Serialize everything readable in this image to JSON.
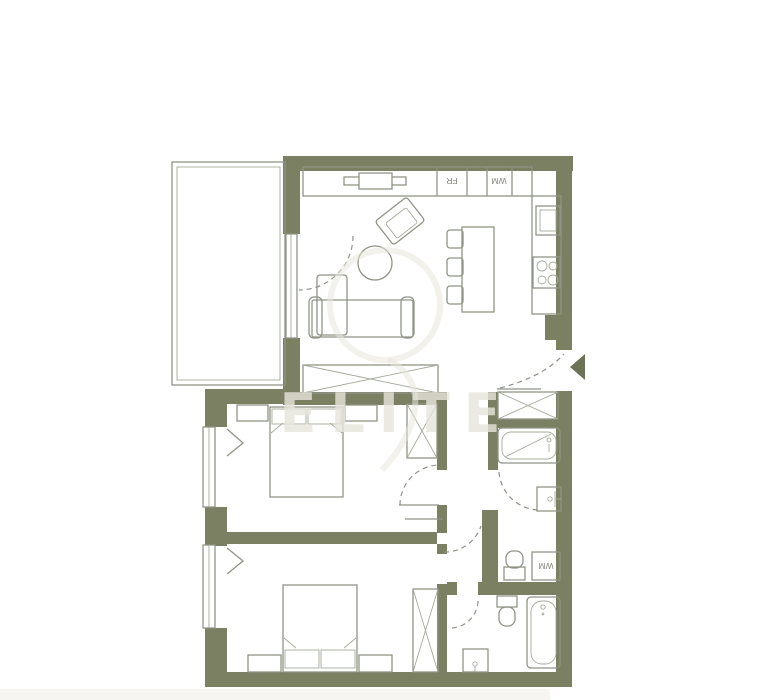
{
  "colors": {
    "bg": "#ffffff",
    "wall": "#7a8061",
    "line": "#8f9486",
    "line-soft": "#a6ab9c",
    "watermark": "#e7e5dc",
    "arrow": "#6d7357",
    "strip": "#f6f5f2"
  },
  "watermark": {
    "text": "ELITE"
  },
  "appliances": {
    "fridge_label": "FR",
    "kitchen_washer_label": "WM",
    "bath_washer_label": "WM"
  },
  "plan": {
    "type": "apartment-floor-plan",
    "rooms": [
      {
        "name": "terrace",
        "symbols": [
          "terrace-outline"
        ]
      },
      {
        "name": "living-kitchen",
        "symbols": [
          "tv-console",
          "fridge-cabinet",
          "washer-cabinet",
          "kitchen-counter",
          "kitchen-sink",
          "stove-4-burners",
          "kitchen-island",
          "bar-stools",
          "armchair",
          "round-table",
          "sofa",
          "terrace-door-swing"
        ]
      },
      {
        "name": "hallway",
        "symbols": [
          "entrance-door-swing",
          "entrance-arrow",
          "built-in-wardrobe"
        ]
      },
      {
        "name": "bedroom-1",
        "symbols": [
          "double-bed",
          "pillows",
          "bedside-shelves",
          "wardrobe",
          "window",
          "door-swing"
        ]
      },
      {
        "name": "bedroom-2",
        "symbols": [
          "double-bed",
          "pillows",
          "bedside-tables",
          "wardrobe",
          "window"
        ]
      },
      {
        "name": "bathroom-1",
        "symbols": [
          "hall-closet",
          "bathtub",
          "washbasin",
          "toilet",
          "washing-machine",
          "door-swing"
        ]
      },
      {
        "name": "bathroom-2",
        "symbols": [
          "toilet",
          "washbasin",
          "bathtub",
          "door-swing"
        ]
      }
    ]
  }
}
